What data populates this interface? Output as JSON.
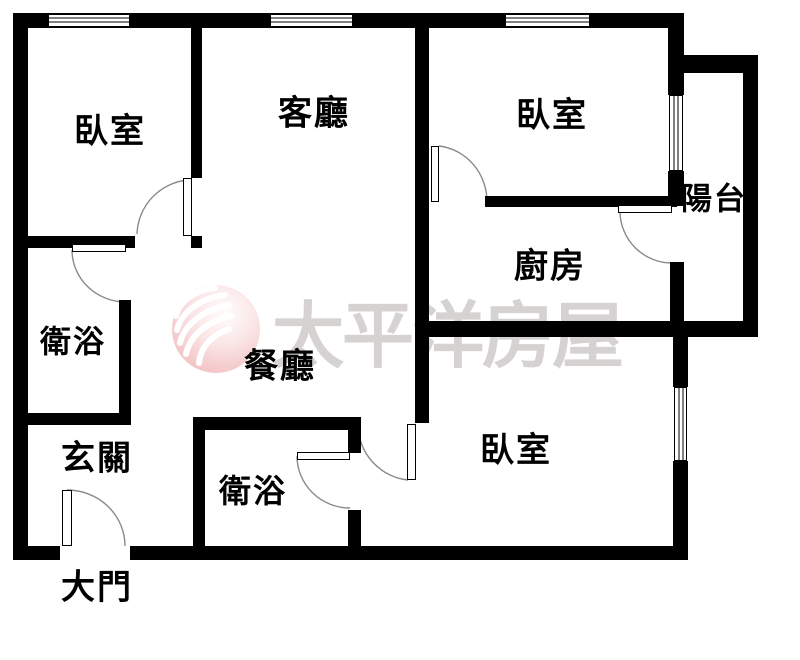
{
  "title": "apartment-floor-plan",
  "watermark": {
    "text": "太平洋房屋",
    "logo_name": "pacific-realty-wave-sphere-logo",
    "text_color": "#d6d2d2",
    "logo_pink": "#f0b6ba"
  },
  "colors": {
    "wall": "#000000",
    "background": "#ffffff",
    "door_arc": "#8a8a8a"
  },
  "rooms": {
    "bedroom_top_left": {
      "label": "臥室"
    },
    "living_room": {
      "label": "客廳"
    },
    "bedroom_top_right": {
      "label": "臥室"
    },
    "balcony": {
      "label": "陽台"
    },
    "kitchen": {
      "label": "廚房"
    },
    "bathroom_left": {
      "label": "衛浴"
    },
    "dining_room": {
      "label": "餐廳"
    },
    "entry_hall": {
      "label": "玄關"
    },
    "bathroom_center": {
      "label": "衛浴"
    },
    "bedroom_bottom": {
      "label": "臥室"
    },
    "main_door": {
      "label": "大門"
    }
  }
}
